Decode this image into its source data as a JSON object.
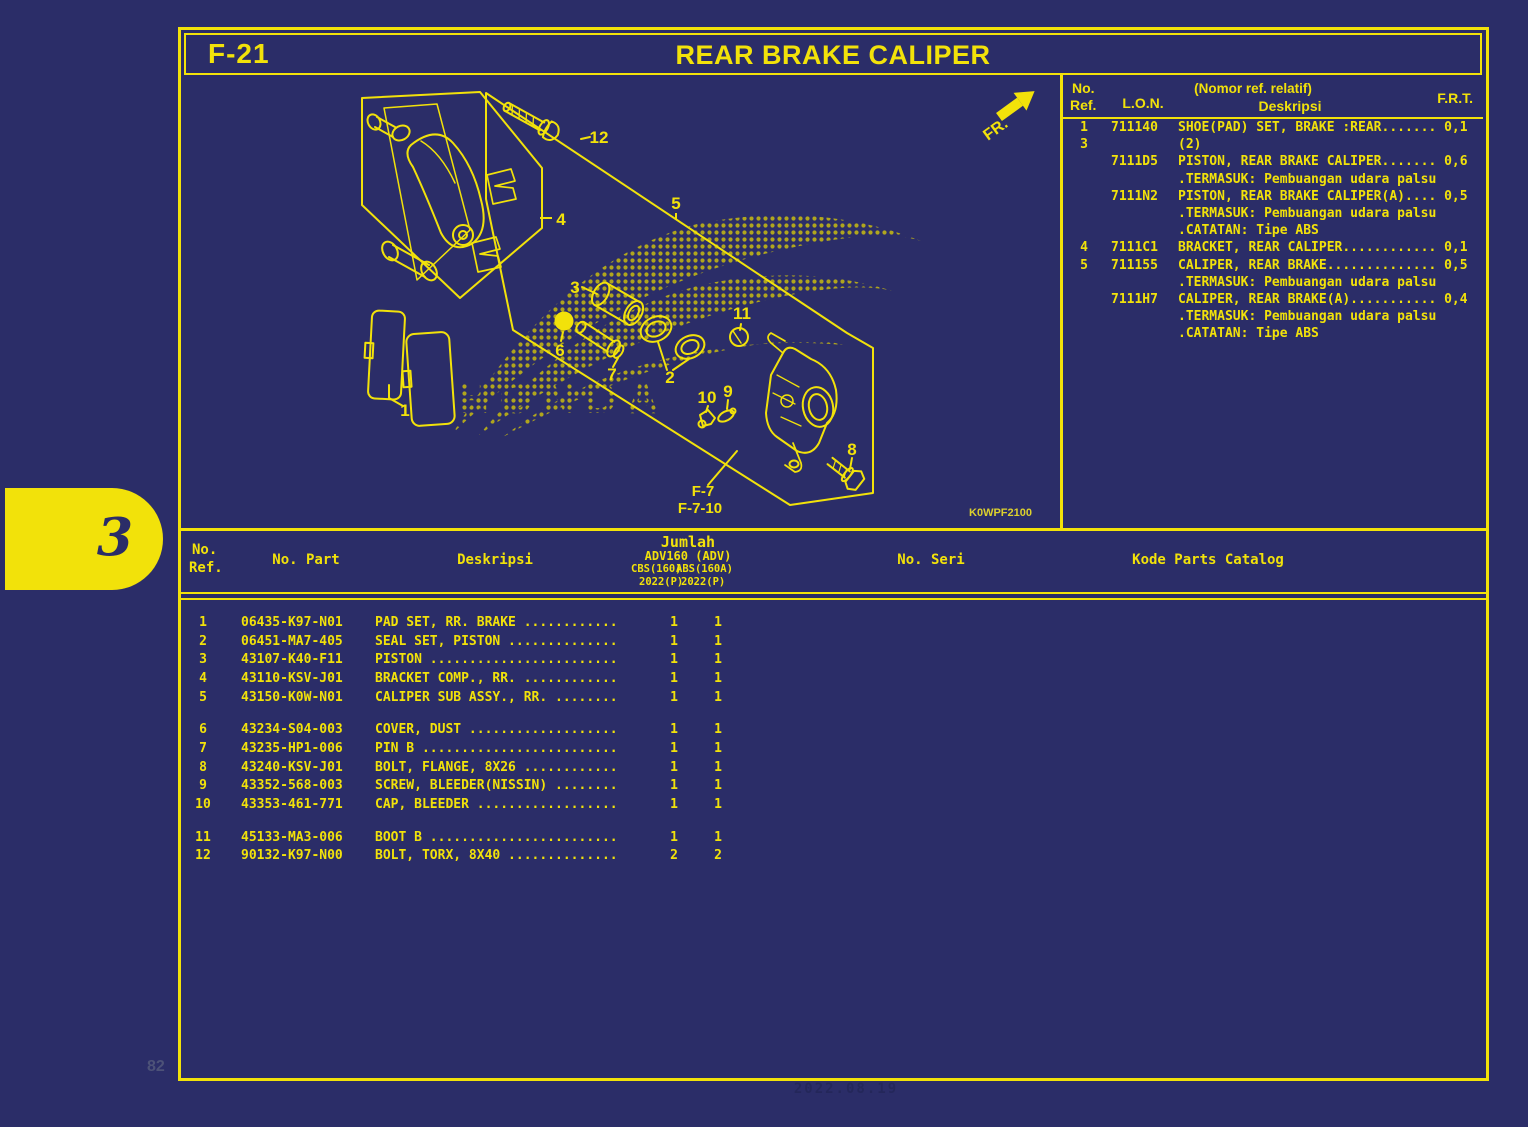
{
  "colors": {
    "background": "#2b2d68",
    "accent_yellow": "#F2E20A"
  },
  "page": {
    "code": "F-21",
    "title": "REAR BRAKE CALIPER",
    "tab_number": "3",
    "page_number": "82",
    "footer_stamp": "2022.08.19"
  },
  "diagram": {
    "fr_label": "FR.",
    "drawing_code": "K0WPF2100",
    "watermark": "HONDA",
    "refs": [
      "F-7",
      "F-7-10"
    ],
    "labels": [
      "1",
      "2",
      "3",
      "4",
      "5",
      "6",
      "7",
      "8",
      "9",
      "10",
      "11",
      "12"
    ]
  },
  "lon_table": {
    "headers": {
      "ref_l1": "No.",
      "ref_l2": "Ref.",
      "lon": "L.O.N.",
      "desc_l1": "(Nomor ref. relatif)",
      "desc_l2": "Deskripsi",
      "frt": "F.R.T."
    },
    "lines": [
      {
        "ref": "1",
        "lon": "711140",
        "text": "SHOE(PAD) SET, BRAKE :REAR....... 0,1"
      },
      {
        "ref": "3",
        "lon": "",
        "text": "(2)"
      },
      {
        "ref": "",
        "lon": "7111D5",
        "text": "PISTON, REAR BRAKE CALIPER....... 0,6"
      },
      {
        "ref": "",
        "lon": "",
        "text": ".TERMASUK: Pembuangan udara palsu"
      },
      {
        "ref": "",
        "lon": "7111N2",
        "text": "PISTON, REAR BRAKE CALIPER(A).... 0,5"
      },
      {
        "ref": "",
        "lon": "",
        "text": ".TERMASUK: Pembuangan udara palsu"
      },
      {
        "ref": "",
        "lon": "",
        "text": ".CATATAN: Tipe ABS"
      },
      {
        "ref": "4",
        "lon": "7111C1",
        "text": "BRACKET, REAR CALIPER............ 0,1"
      },
      {
        "ref": "5",
        "lon": "711155",
        "text": "CALIPER, REAR BRAKE.............. 0,5"
      },
      {
        "ref": "",
        "lon": "",
        "text": ".TERMASUK: Pembuangan udara palsu"
      },
      {
        "ref": "",
        "lon": "7111H7",
        "text": "CALIPER, REAR BRAKE(A)........... 0,4"
      },
      {
        "ref": "",
        "lon": "",
        "text": ".TERMASUK: Pembuangan udara palsu"
      },
      {
        "ref": "",
        "lon": "",
        "text": ".CATATAN: Tipe ABS"
      }
    ]
  },
  "parts_table": {
    "headers": {
      "ref_l1": "No.",
      "ref_l2": "Ref.",
      "part": "No. Part",
      "desc": "Deskripsi",
      "jumlah": "Jumlah",
      "model": "ADV160 (ADV)",
      "variant1": "CBS(160)",
      "variant2": "ABS(160A)",
      "year1": "2022(P)",
      "year2": "2022(P)",
      "seri": "No. Seri",
      "kode": "Kode Parts Catalog"
    },
    "rows": [
      {
        "ref": "1",
        "part": "06435-K97-N01",
        "desc": "PAD SET, RR. BRAKE ............",
        "q1": "1",
        "q2": "1",
        "gap": false
      },
      {
        "ref": "2",
        "part": "06451-MA7-405",
        "desc": "SEAL SET, PISTON ..............",
        "q1": "1",
        "q2": "1",
        "gap": false
      },
      {
        "ref": "3",
        "part": "43107-K40-F11",
        "desc": "PISTON ........................",
        "q1": "1",
        "q2": "1",
        "gap": false
      },
      {
        "ref": "4",
        "part": "43110-KSV-J01",
        "desc": "BRACKET COMP., RR. ............",
        "q1": "1",
        "q2": "1",
        "gap": false
      },
      {
        "ref": "5",
        "part": "43150-K0W-N01",
        "desc": "CALIPER SUB ASSY., RR. ........",
        "q1": "1",
        "q2": "1",
        "gap": false
      },
      {
        "ref": "6",
        "part": "43234-S04-003",
        "desc": "COVER, DUST ...................",
        "q1": "1",
        "q2": "1",
        "gap": true
      },
      {
        "ref": "7",
        "part": "43235-HP1-006",
        "desc": "PIN B .........................",
        "q1": "1",
        "q2": "1",
        "gap": false
      },
      {
        "ref": "8",
        "part": "43240-KSV-J01",
        "desc": "BOLT, FLANGE, 8X26 ............",
        "q1": "1",
        "q2": "1",
        "gap": false
      },
      {
        "ref": "9",
        "part": "43352-568-003",
        "desc": "SCREW, BLEEDER(NISSIN) ........",
        "q1": "1",
        "q2": "1",
        "gap": false
      },
      {
        "ref": "10",
        "part": "43353-461-771",
        "desc": "CAP, BLEEDER ..................",
        "q1": "1",
        "q2": "1",
        "gap": false
      },
      {
        "ref": "11",
        "part": "45133-MA3-006",
        "desc": "BOOT B ........................",
        "q1": "1",
        "q2": "1",
        "gap": true
      },
      {
        "ref": "12",
        "part": "90132-K97-N00",
        "desc": "BOLT, TORX, 8X40 ..............",
        "q1": "2",
        "q2": "2",
        "gap": false
      }
    ]
  }
}
